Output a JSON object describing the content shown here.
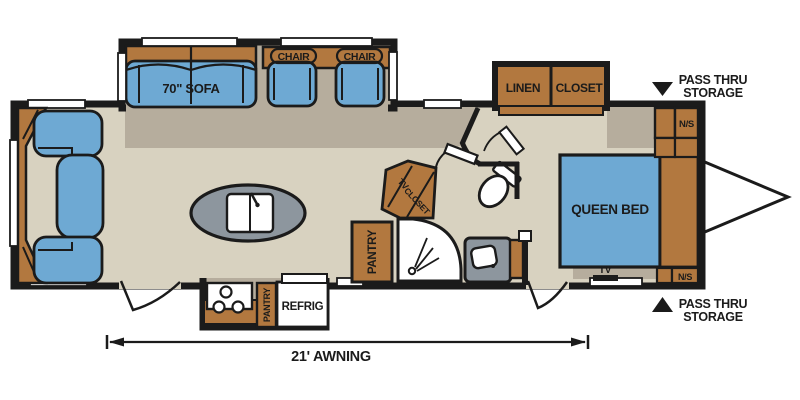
{
  "colors": {
    "ink": "#1b1b1b",
    "floor": "#d8d2c0",
    "shadow": "#b6ad9d",
    "wood": "#b2783f",
    "cushion": "#6ea9d3",
    "counter": "#8d969e",
    "white": "#ffffff"
  },
  "labels": {
    "sofa": "70\" SOFA",
    "chair_left": "CHAIR",
    "chair_right": "CHAIR",
    "linen": "LINEN",
    "linen_closet": "CLOSET",
    "pass_thru_top": {
      "line1": "PASS THRU",
      "line2": "STORAGE"
    },
    "pass_thru_bottom": {
      "line1": "PASS THRU",
      "line2": "STORAGE"
    },
    "ns_top": "N/S",
    "ns_bottom": "N/S",
    "queen_bed": "QUEEN BED",
    "tv_bedroom": "TV",
    "tv_cabinet": "TV",
    "closet_cabinet": "CLOSET",
    "pantry_main": "PANTRY",
    "pantry_kitchen": "PANTRY",
    "refrig": "REFRIG",
    "awning": "21' AWNING"
  }
}
